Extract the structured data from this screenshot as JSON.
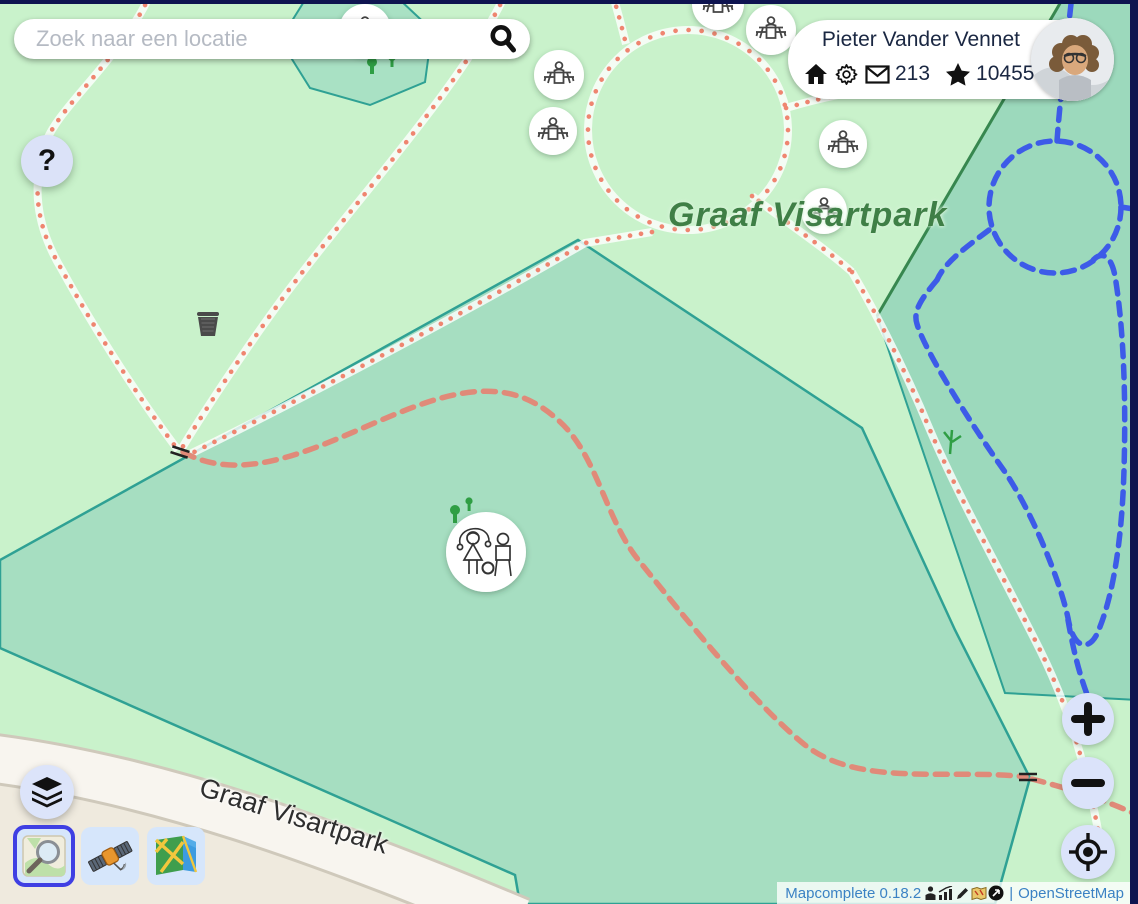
{
  "search": {
    "placeholder": "Zoek naar een locatie"
  },
  "help": {
    "label": "?"
  },
  "user": {
    "name": "Pieter Vander Vennet",
    "messages": "213",
    "changesets": "10455"
  },
  "map_labels": {
    "park": "Graaf Visartpark",
    "street": "Graaf Visartpark"
  },
  "attribution": {
    "app": "Mapcomplete 0.18.2",
    "separator": "|",
    "osm": "OpenStreetMap"
  },
  "icons": {
    "search": "magnifier-icon",
    "help": "question-mark",
    "user_row": [
      "home-icon",
      "gear-icon",
      "mail-icon",
      "star-icon",
      "logout-icon"
    ],
    "controls": [
      "layers-icon",
      "zoom-in-icon",
      "zoom-out-icon",
      "geolocate-icon"
    ],
    "backgrounds": [
      "osm-carto-style",
      "satellite-style",
      "folded-map-style"
    ],
    "attribution_row": [
      "contributor-icon",
      "stats-icon",
      "edit-icon",
      "map-icon",
      "arrow-circle-icon"
    ],
    "map_markers": [
      "picnic-table-marker",
      "playground-marker",
      "waste-basket-icon",
      "gate-icon",
      "tree-icon"
    ]
  },
  "colors": {
    "park_green": "#c9f2cb",
    "meadow_teal": "#a6dec1",
    "garden_teal": "#9cd9bc",
    "path_red": "#ef8570",
    "path_blue": "#3d5be8",
    "road_beige": "#f8f5ef",
    "selected_border_blue": "#3f3fe3",
    "control_lavender": "#dbe3fa",
    "frame_navy": "#0e1450",
    "attribution_blue": "#3b82c4",
    "park_label_green": "#3f7f46"
  }
}
